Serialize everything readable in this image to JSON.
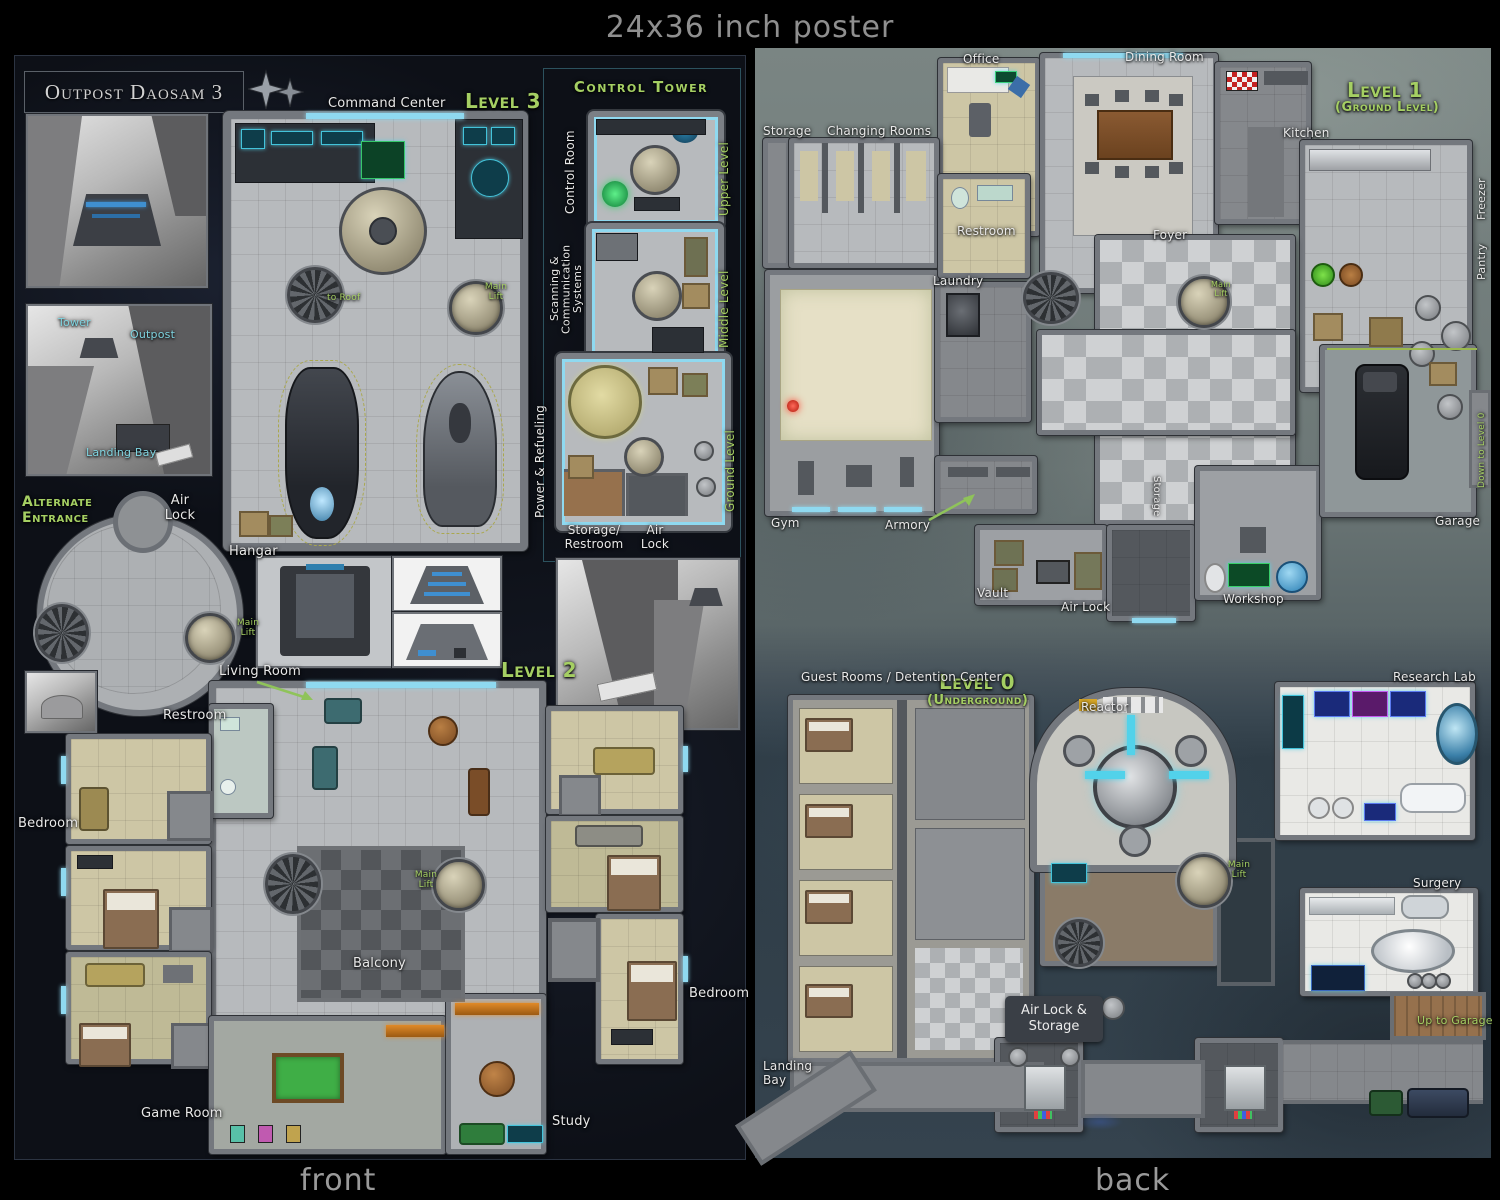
{
  "page": {
    "top_caption": "24x36 inch poster",
    "front_caption": "front",
    "back_caption": "back"
  },
  "colors": {
    "level_label_green": "#a5cf63",
    "room_label_white": "#e8e8e8",
    "inset_label_cyan": "#7fd4e0",
    "door_accent_cyan": "#8fd9f0"
  },
  "front": {
    "title": "Outpost Daosam 3",
    "level3": {
      "heading": "Level 3",
      "command_center": "Command Center",
      "to_roof": "to Roof",
      "main_lift": "Main Lift"
    },
    "control_tower": {
      "title": "Control Tower",
      "upper": {
        "room": "Control Room",
        "level": "Upper Level"
      },
      "middle": {
        "room": "Scanning & Communication Systems",
        "level": "Middle Level"
      },
      "ground": {
        "room": "Power & Refueling",
        "level": "Ground Level",
        "storage_restroom": "Storage/ Restroom",
        "air_lock": "Air Lock"
      }
    },
    "alternate_entrance": {
      "title": "Alternate Entrance",
      "air_lock": "Air Lock",
      "main_lift": "Main Lift"
    },
    "hangar_label": "Hangar",
    "cliff_inset": {
      "tower": "Tower",
      "outpost": "Outpost",
      "landing_bay": "Landing Bay"
    },
    "level2": {
      "heading": "Level 2",
      "living_room": "Living Room",
      "restroom": "Restroom",
      "bedroom_left": "Bedroom",
      "bedroom_right": "Bedroom",
      "game_room": "Game Room",
      "study": "Study",
      "balcony": "Balcony",
      "main_lift": "Main Lift"
    }
  },
  "back": {
    "level1": {
      "heading": "Level 1",
      "subheading": "(Ground Level)",
      "office": "Office",
      "dining_room": "Dining Room",
      "kitchen": "Kitchen",
      "storage_top": "Storage",
      "changing_rooms": "Changing Rooms",
      "restroom": "Restroom",
      "foyer": "Foyer",
      "laundry": "Laundry",
      "freezer": "Freezer",
      "pantry": "Pantry",
      "down_to_level_0": "Down to Level 0",
      "gym": "Gym",
      "armory": "Armory",
      "vault": "Vault",
      "air_lock": "Air Lock",
      "storage_side": "Storage",
      "workshop": "Workshop",
      "garage": "Garage",
      "main_lift": "Main Lift"
    },
    "level0": {
      "heading": "Level 0",
      "subheading": "(Underground)",
      "guest_rooms": "Guest Rooms / Detention Center",
      "reactor": "Reactor",
      "research_lab": "Research Lab",
      "main_lift": "Main Lift",
      "surgery": "Surgery",
      "up_to_garage": "Up to Garage",
      "air_lock_storage": "Air Lock & Storage",
      "landing_bay": "Landing Bay"
    }
  }
}
